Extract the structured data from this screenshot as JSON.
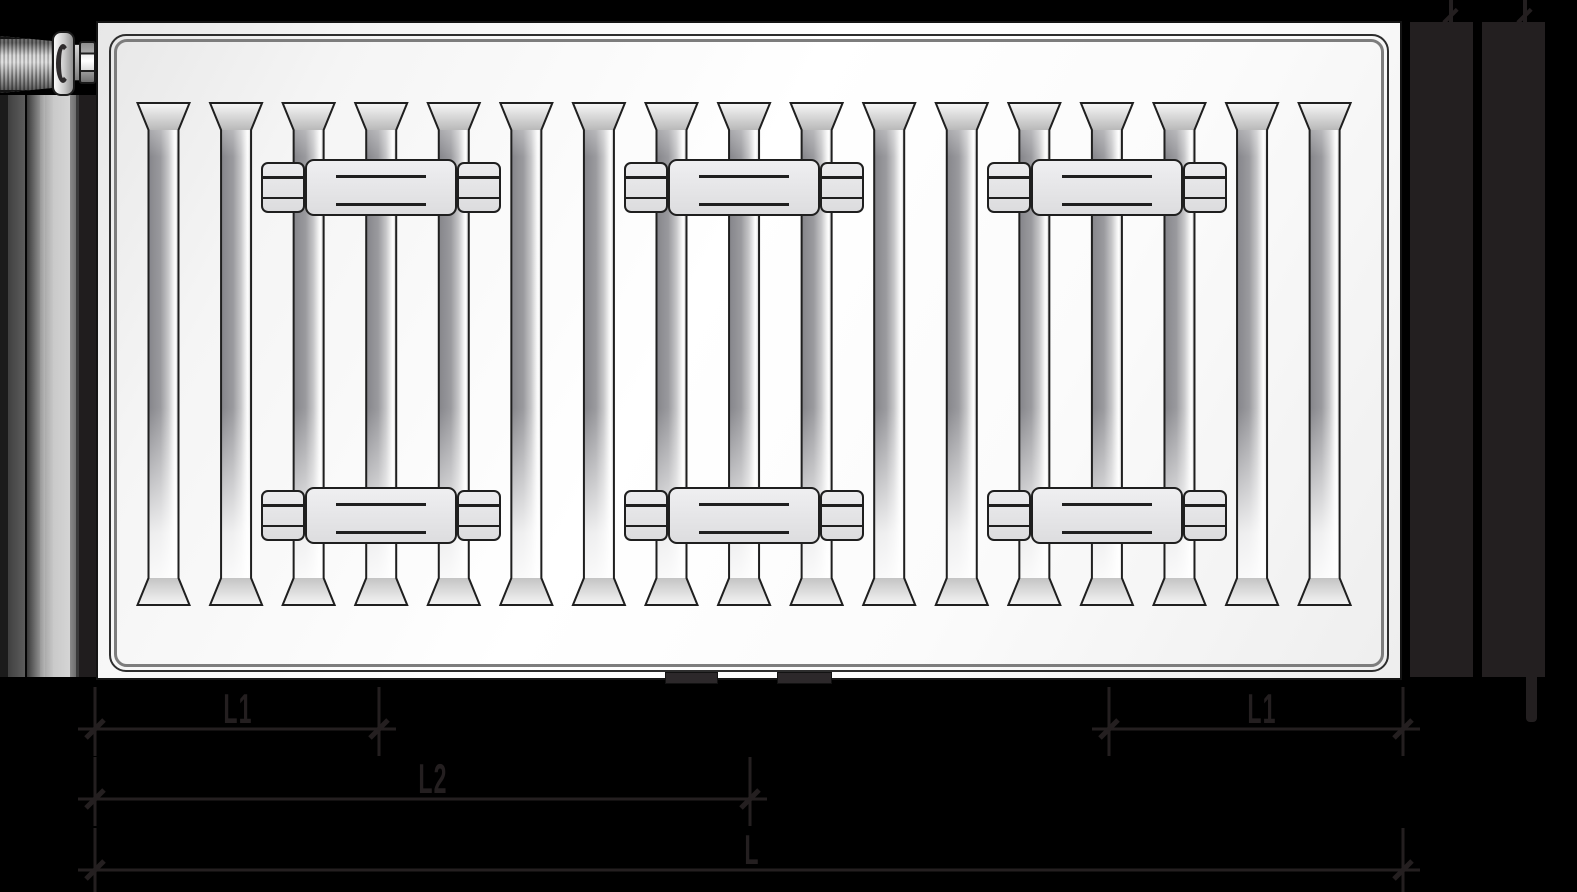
{
  "drawing": {
    "description": "Panel radiator technical dimension drawing: front view with valve, left and right side profiles, mounting brackets and length dimensions",
    "dimension_labels": [
      "L1",
      "L2",
      "L"
    ]
  },
  "diagram": {
    "canvas": {
      "width": 1577,
      "height": 892,
      "background": "#000000"
    },
    "colors": {
      "dimension_art": "#241f20",
      "outline": "#1f1f1f",
      "panel_white": "#ffffff",
      "bracket_fill": "#e6e6e8",
      "side_bar_fill": "#231f20"
    },
    "panel": {
      "x": 96,
      "y": 21,
      "width": 1306,
      "height": 659,
      "corner_radius": 17
    },
    "grooves": {
      "count": 17,
      "first_left": 137.5,
      "pitch": 72.57,
      "width": 52,
      "channel_inset": 11,
      "top": 103,
      "bevel_height": 27,
      "bottom": 605
    },
    "brackets": {
      "centers_x": [
        381,
        744,
        1107
      ],
      "row_tops_y": [
        159,
        487
      ],
      "height": 57,
      "clamp_width": 44,
      "plate_width": 152,
      "band_inset_y": 12,
      "plate_line_offsets_y": [
        14,
        42
      ]
    },
    "feet": {
      "y": 672,
      "h": 12,
      "items": [
        {
          "x": 665,
          "w": 53
        },
        {
          "x": 777,
          "w": 55
        }
      ]
    },
    "side_view_left": {
      "top": 95,
      "bottom": 677,
      "strips": [
        {
          "x": 0,
          "w": 8,
          "fill": "#1b1b1b"
        },
        {
          "x": 8,
          "w": 17,
          "fill": "linear-gradient(to right,#404040,#5d5d5d)"
        },
        {
          "x": 25,
          "w": 2,
          "fill": "#050505"
        },
        {
          "x": 27,
          "w": 13,
          "fill": "linear-gradient(to right,#3a3a3a,#8f8f8f)"
        },
        {
          "x": 40,
          "w": 5,
          "fill": "linear-gradient(to right,#989898,#b5b5b5)"
        },
        {
          "x": 45,
          "w": 8,
          "fill": "linear-gradient(to right,#ababab,#c6c6c6)"
        },
        {
          "x": 53,
          "w": 17,
          "fill": "linear-gradient(to right,#c9c9c9,#d5d5d5)"
        },
        {
          "x": 70,
          "w": 6,
          "fill": "linear-gradient(to right,#8a8a8a,#6e6e6e)"
        },
        {
          "x": 76,
          "w": 3,
          "fill": "#3a3a3a"
        },
        {
          "x": 79,
          "w": 17,
          "fill": "#201d1e"
        }
      ]
    },
    "side_view_right": {
      "top": 22,
      "bottom": 677,
      "bars": [
        {
          "x": 1410,
          "w": 63
        },
        {
          "x": 1482,
          "w": 63
        }
      ],
      "top_stubs": [
        {
          "x": 1449,
          "w": 4
        },
        {
          "x": 1523,
          "w": 4
        }
      ],
      "top_stub_height": 22,
      "bottom_stub": {
        "x": 1526,
        "w": 11,
        "y": 677,
        "h": 45
      }
    },
    "valve": {
      "parts": [
        "thermostatic-head",
        "flange",
        "stem",
        "connection-nut"
      ]
    },
    "dimensions": {
      "line_overshoot": 17,
      "ext_above": 42,
      "ext_below": 27,
      "rows": [
        {
          "y": 729,
          "segments": [
            {
              "x1": 95,
              "x2": 379,
              "label": "L1",
              "label_x": 238
            },
            {
              "x1": 1109,
              "x2": 1403,
              "label": "L1",
              "label_x": 1262
            }
          ]
        },
        {
          "y": 799,
          "segments": [
            {
              "x1": 95,
              "x2": 750,
              "label": "L2",
              "label_x": 433
            }
          ]
        },
        {
          "y": 870,
          "segments": [
            {
              "x1": 95,
              "x2": 1403,
              "label": "L",
              "label_x": 752
            }
          ]
        }
      ]
    }
  }
}
